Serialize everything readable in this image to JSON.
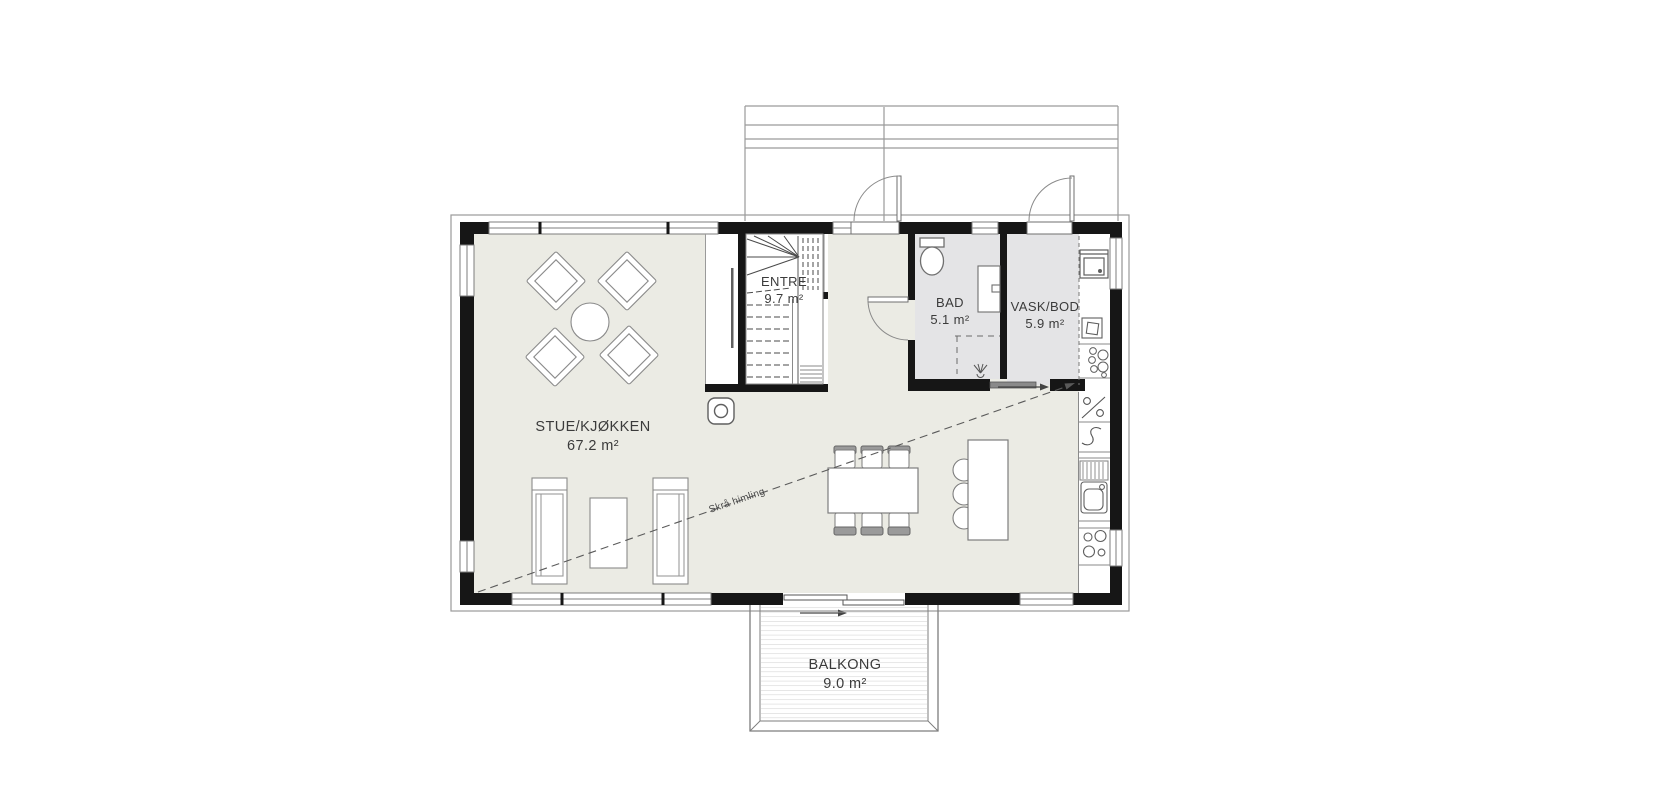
{
  "title": "First floor plan",
  "rooms": {
    "stue": {
      "name": "STUE/KJØKKEN",
      "area": "67.2 m²"
    },
    "entre": {
      "name": "ENTRE",
      "area": "9.7 m²"
    },
    "bad": {
      "name": "BAD",
      "area": "5.1 m²"
    },
    "vask_bod": {
      "name": "VASK/BOD",
      "area": "5.9 m²"
    },
    "balkong": {
      "name": "BALKONG",
      "area": "9.0 m²"
    }
  },
  "annotations": {
    "sloped_ceiling": "Skrå himling"
  },
  "colors": {
    "floor": "#ebebe4",
    "wetroom": "#e4e4e6",
    "wall": "#161616",
    "outline": "#8c8c8c",
    "deck_line": "#cfcfcf",
    "text": "#3b3b3b"
  }
}
